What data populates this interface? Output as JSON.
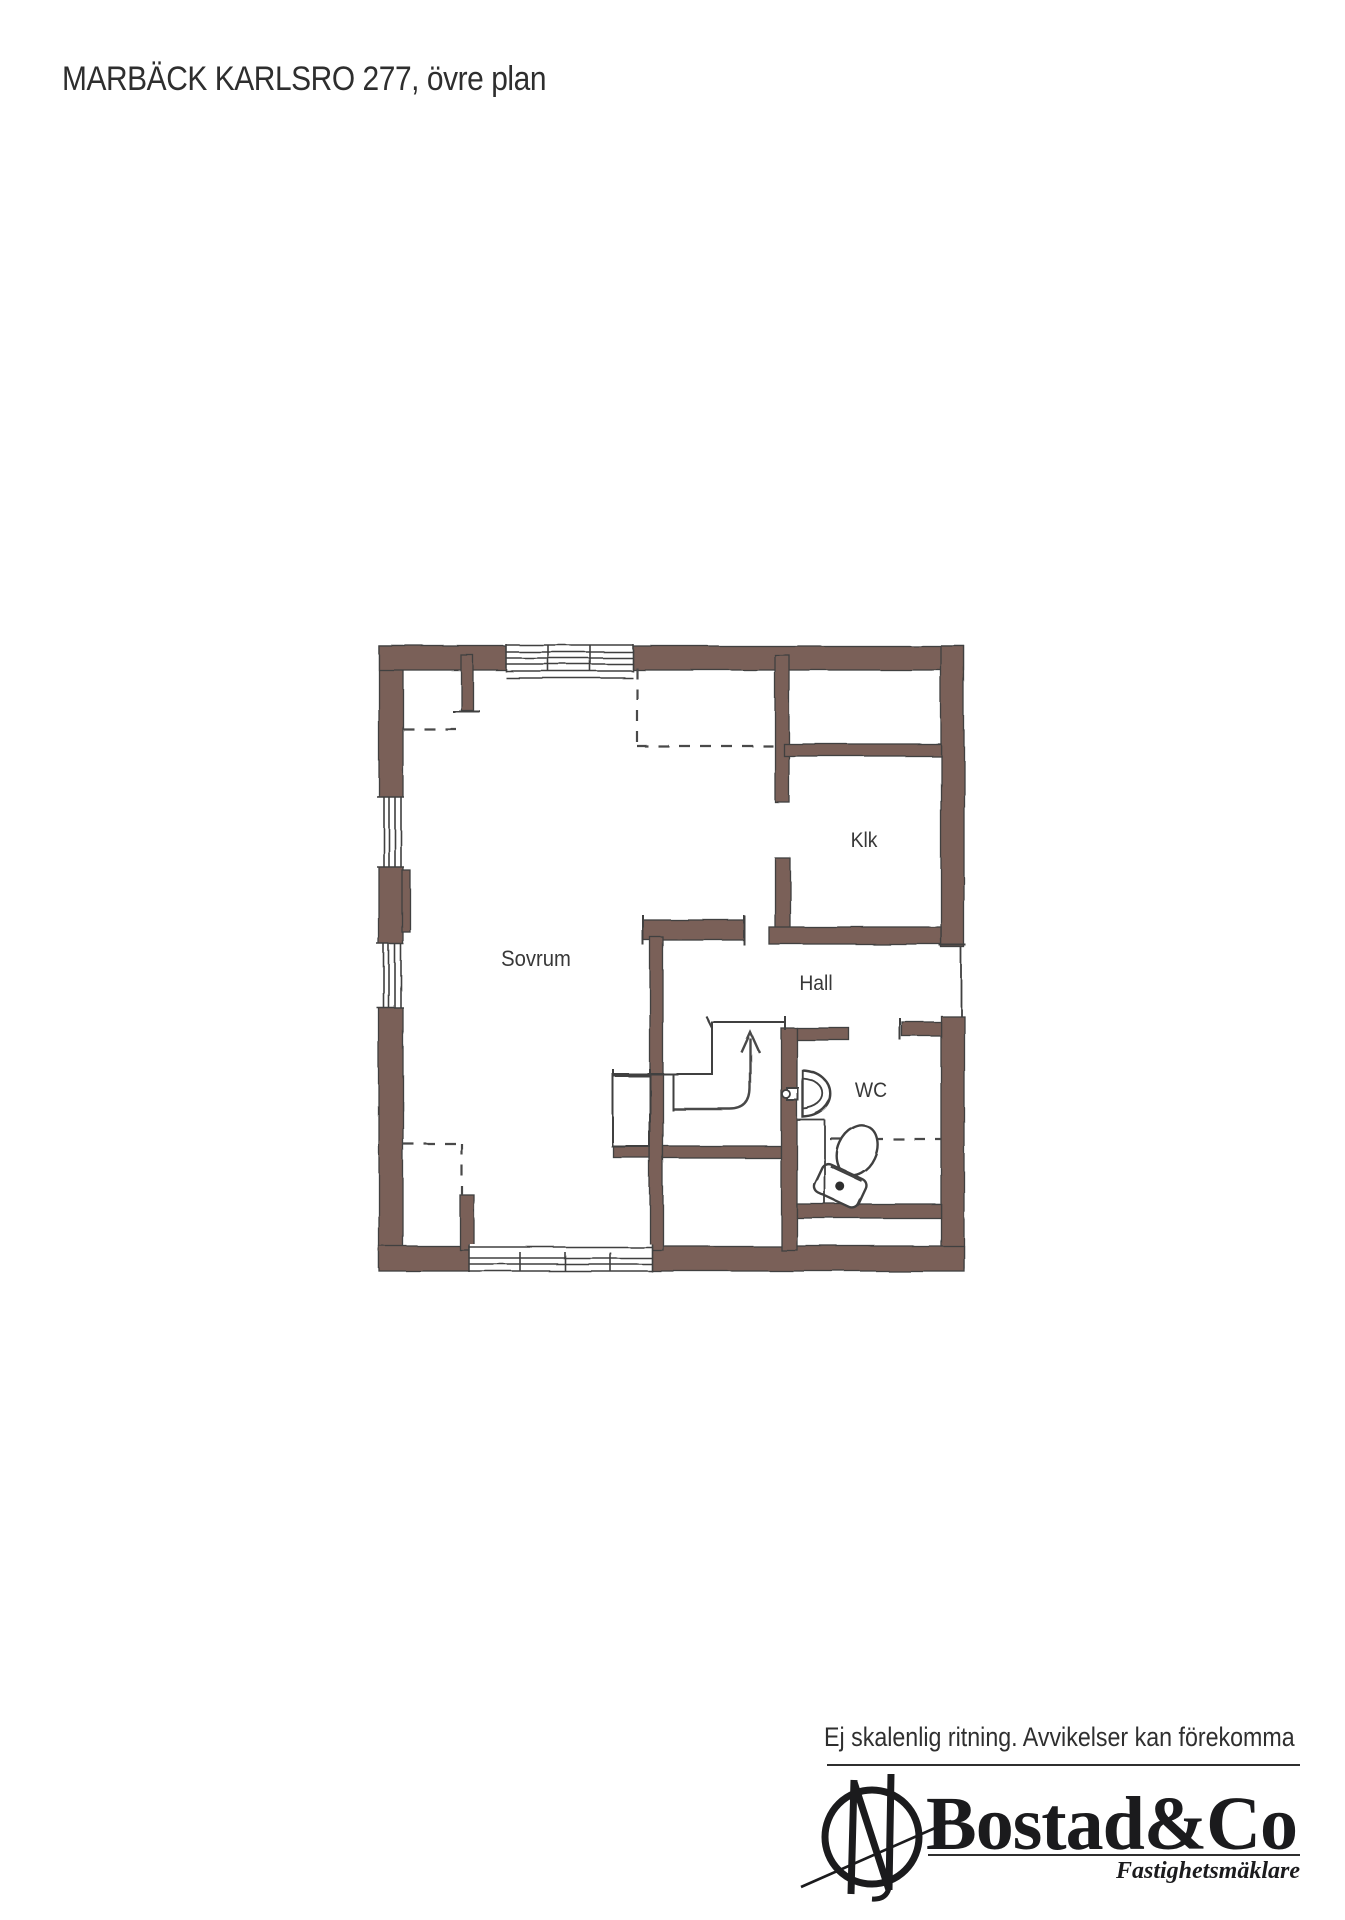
{
  "title": "MARBÄCK KARLSRO 277, övre plan",
  "rooms": {
    "sovrum": "Sovrum",
    "klk": "Klk",
    "hall": "Hall",
    "wc": "WC"
  },
  "footer": {
    "disclaimer": "Ej skalenlig ritning. Avvikelser kan förekomma",
    "brand": "Bostad&Co",
    "brand_sub": "Fastighetsmäklare"
  },
  "colors": {
    "wall": "#7a6159",
    "line": "#3f3f3f",
    "dashed": "#4a4a4a",
    "text": "#383838",
    "logo": "#1b1b1d"
  }
}
